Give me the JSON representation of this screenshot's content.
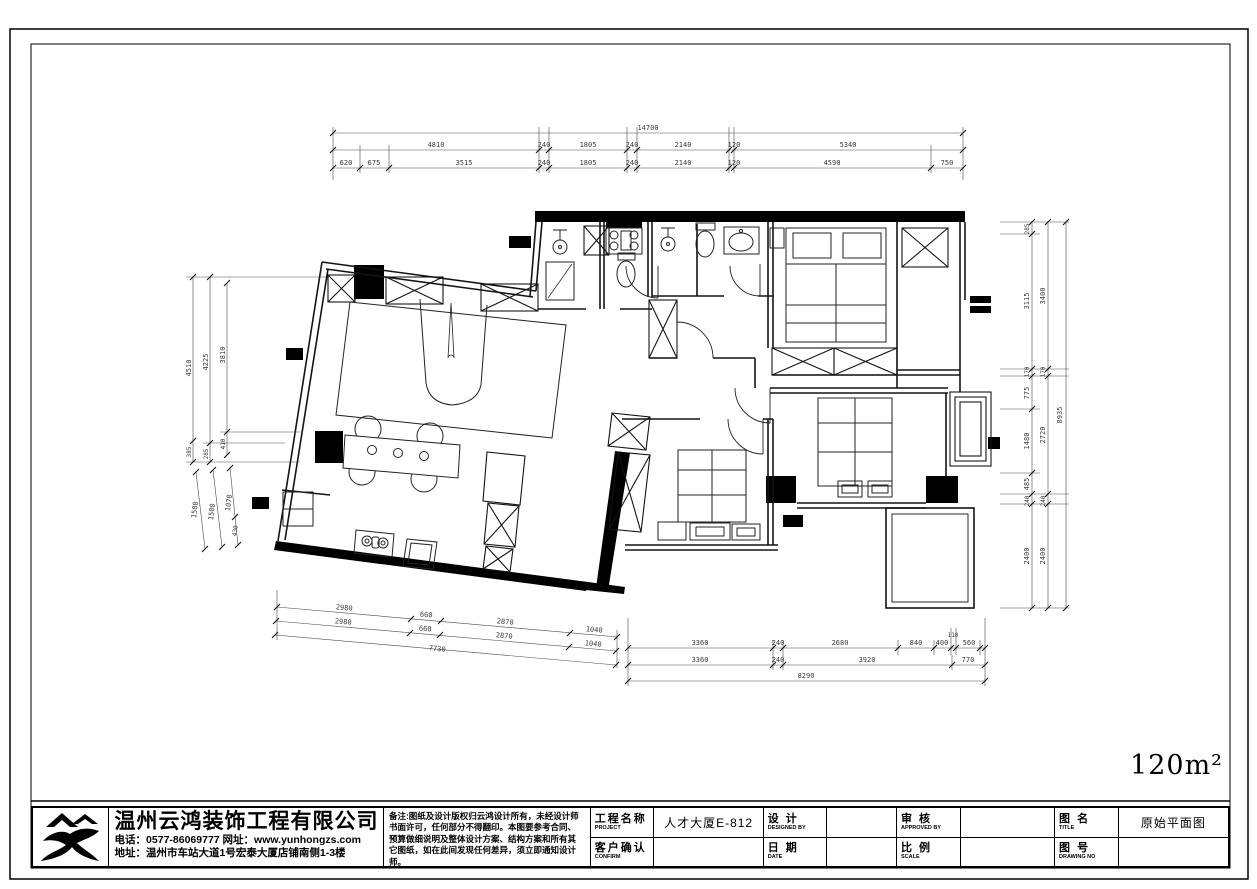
{
  "sheet": {
    "area_label": "120m²"
  },
  "dims": {
    "top1": [
      "14700"
    ],
    "top2": [
      "4810",
      "240",
      "1805",
      "240",
      "2140",
      "120",
      "5340"
    ],
    "top3": [
      "620",
      "675",
      "3515",
      "240",
      "1805",
      "240",
      "2140",
      "120",
      "4590",
      "750"
    ],
    "left_v": [
      "4510",
      "4225",
      "3810",
      "385",
      "285",
      "410"
    ],
    "left_s": [
      "1500",
      "1500",
      "1070",
      "430"
    ],
    "right1": [
      "285",
      "3115",
      "170",
      "775",
      "1480",
      "485",
      "240",
      "2400"
    ],
    "right2": [
      "3400",
      "170",
      "2720",
      "240",
      "2400"
    ],
    "right3": [
      "8935"
    ],
    "bl1": [
      "2980",
      "660",
      "2870",
      "1040"
    ],
    "bl2": [
      "2980",
      "660",
      "2870",
      "1040"
    ],
    "bl3": [
      "7730"
    ],
    "br1": [
      "3360",
      "240",
      "2680",
      "840",
      "400",
      "110",
      "560"
    ],
    "br2": [
      "3360",
      "240",
      "3920",
      "770"
    ],
    "br3": [
      "8290"
    ]
  },
  "titleblock": {
    "company": "温州云鸿装饰工程有限公司",
    "phone_line": "电话：0577-86069777 网址：www.yunhongzs.com",
    "addr_line": "地址：温州市车站大道1号宏泰大厦店铺南侧1-3楼",
    "notes": "备注:图纸及设计版权归云鸿设计所有，未经设计师\n书面许可，任何部分不得翻印。本图要参考合同、\n预算做细说明及整体设计方案、结构方案和所有其\n它图纸，如在此间发现任何差异，须立即通知设计师。",
    "fields": {
      "project_label": "工程名称",
      "project_sub": "PROJECT",
      "project_value": "人才大厦E-812",
      "confirm_label": "客户确认",
      "confirm_sub": "CONFIRM",
      "confirm_value": "",
      "design_label": "设  计",
      "design_sub": "DESIGNED BY",
      "design_value": "",
      "date_label": "日  期",
      "date_sub": "DATE",
      "date_value": "",
      "approve_label": "审  核",
      "approve_sub": "APPROVED BY",
      "approve_value": "",
      "scale_label": "比  例",
      "scale_sub": "SCALE",
      "scale_value": "",
      "title_label": "图  名",
      "title_sub": "TITLE",
      "title_value": "原始平面图",
      "dwgno_label": "图  号",
      "dwgno_sub": "DRAWING NO",
      "dwgno_value": ""
    }
  }
}
